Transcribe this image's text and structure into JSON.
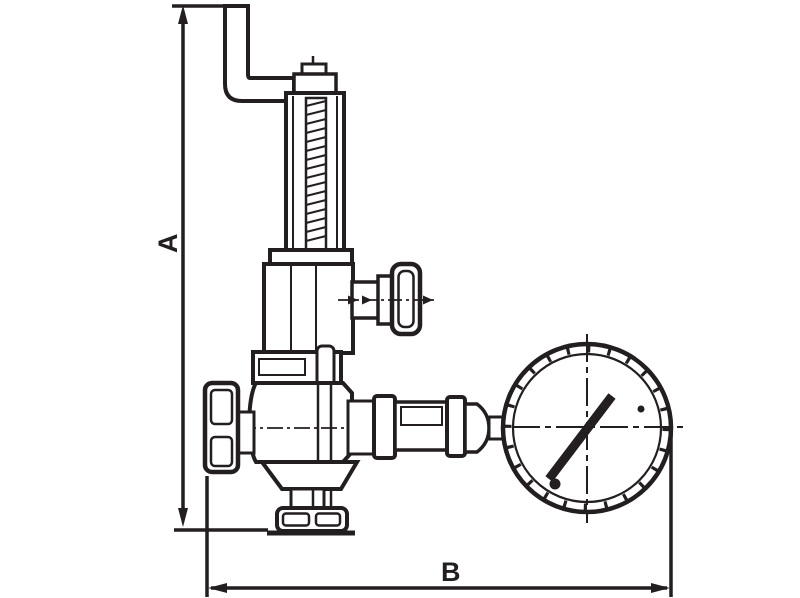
{
  "drawing": {
    "background_color": "#ffffff",
    "ink_color": "#231f20",
    "labels": {
      "height_dimension": "A",
      "width_dimension": "B"
    }
  }
}
